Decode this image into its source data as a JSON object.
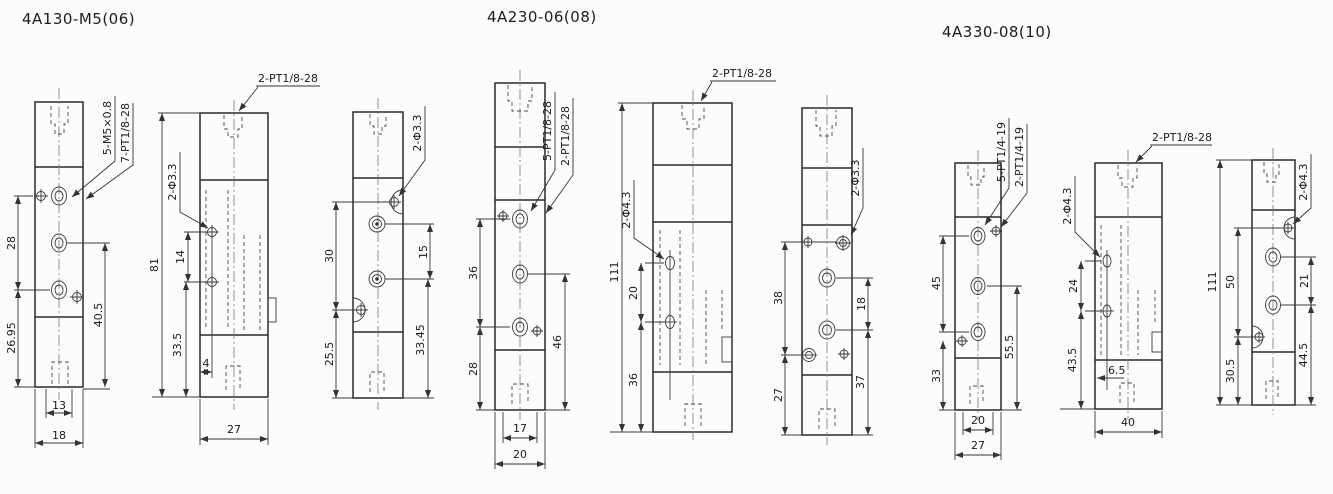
{
  "drawing": {
    "titles": {
      "group1": "4A130-M5(06)",
      "group2": "4A230-06(08)",
      "group3": "4A330-08(10)"
    },
    "v1": {
      "callout1": "5-M5×0.8",
      "callout2": "7-PT1/8-28",
      "dim_left_top": "28",
      "dim_left_bottom": "26.95",
      "dim_right": "40.5",
      "dim_bottom_inner": "13",
      "dim_bottom_outer": "18"
    },
    "v2": {
      "callout_top": "2-PT1/8-28",
      "callout_side": "2-Φ3.3",
      "dim_height": "81",
      "dim_holes": "14",
      "dim_lower": "33.5",
      "dim_offset": "4",
      "dim_width": "27"
    },
    "v3": {
      "callout_side": "2-Φ3.3",
      "dim_left_top": "30",
      "dim_left_bottom": "25.5",
      "dim_right_top": "15",
      "dim_right_bottom": "33.45"
    },
    "v4": {
      "callout1": "5-PT1/8-28",
      "callout2": "2-PT1/8-28",
      "dim_left_top": "36",
      "dim_left_bottom": "28",
      "dim_right": "46",
      "dim_bottom_inner": "17",
      "dim_bottom_outer": "20"
    },
    "v5": {
      "callout_top": "2-PT1/8-28",
      "callout_side": "2-Φ4.3",
      "dim_height": "111",
      "dim_holes": "20",
      "dim_lower": "36"
    },
    "v6": {
      "callout_side": "2-Φ3.3",
      "dim_left_top": "38",
      "dim_left_bottom": "27",
      "dim_right_top": "18",
      "dim_right_bottom": "37"
    },
    "v7": {
      "callout1": "5-PT1/4-19",
      "callout2": "2-PT1/4-19",
      "dim_left_top": "45",
      "dim_left_bottom": "33",
      "dim_right": "55.5",
      "dim_bottom_inner": "20",
      "dim_bottom_outer": "27"
    },
    "v8": {
      "callout_top": "2-PT1/8-28",
      "callout_side": "2-Φ4.3",
      "dim_holes": "24",
      "dim_lower": "43.5",
      "dim_offset": "6.5",
      "dim_width": "40"
    },
    "v9": {
      "callout_side": "2-Φ4.3",
      "dim_height": "111",
      "dim_left_mid": "50",
      "dim_left_bottom": "30.5",
      "dim_right_top": "21",
      "dim_right_bottom": "44.5"
    }
  }
}
